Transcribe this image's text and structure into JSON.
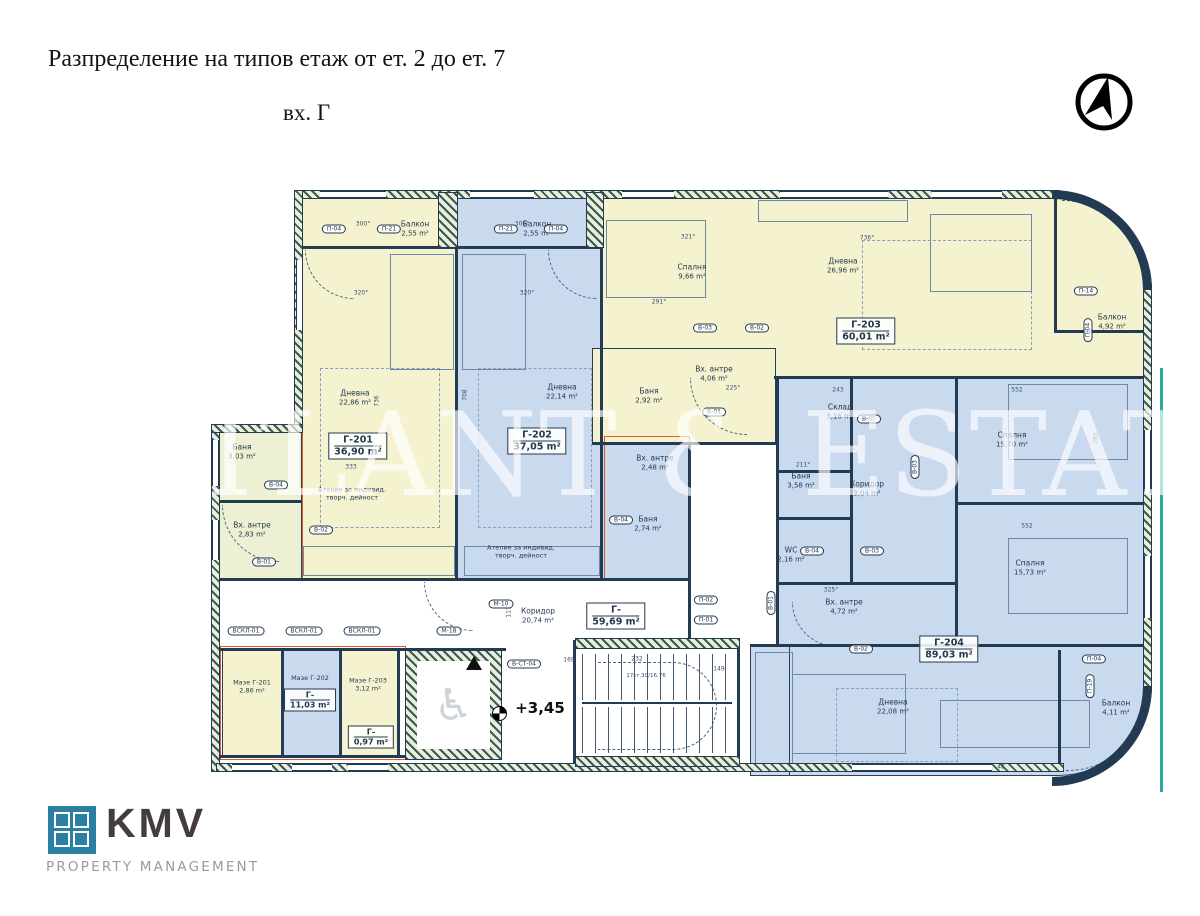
{
  "header": {
    "title": "Разпределение на типов етаж от ет. 2 до ет. 7",
    "entrance": "вх. Г"
  },
  "watermark": "ATLANT & ESTATE",
  "brand": {
    "name": "KMV",
    "tagline": "PROPERTY MANAGEMENT"
  },
  "level_mark": "+3,45",
  "stairs_note": "17ст.30/16,76",
  "colors": {
    "apartment_yellow": "#f5f2cf",
    "apartment_blue": "#c9daef",
    "annex_green": "#edf0d2",
    "line": "#223a52",
    "accent_red": "#dd5c2e",
    "frame_teal": "#2fa8a4",
    "logo_teal": "#2b7fa3"
  },
  "boxes": [
    {
      "id": "Г-201",
      "area": "36,90 m²"
    },
    {
      "id": "Г-202",
      "area": "37,05 m²"
    },
    {
      "id": "Г-203",
      "area": "60,01 m²"
    },
    {
      "id": "Г-204",
      "area": "89,03 m²"
    },
    {
      "id": "Г-",
      "area": "59,69 m²"
    },
    {
      "id": "Г-",
      "area": "11,03 m²"
    },
    {
      "id": "Г-",
      "area": "0,97 m²"
    }
  ],
  "rooms": [
    {
      "l1": "Дневна",
      "l2": "22,86 m²"
    },
    {
      "l1": "Балкон",
      "l2": "2,55 m²"
    },
    {
      "l1": "Ателие за индивид.",
      "l2": "творч. дейност"
    },
    {
      "l1": "Баня",
      "l2": "3,03 m²"
    },
    {
      "l1": "Вх. антре",
      "l2": "2,83 m²"
    },
    {
      "l1": "Дневна",
      "l2": "22,14 m²"
    },
    {
      "l1": "Балкон",
      "l2": "2,55 m²"
    },
    {
      "l1": "Ателие за индивид.",
      "l2": "творч. дейност"
    },
    {
      "l1": "Вх. антре",
      "l2": "2,48 m²"
    },
    {
      "l1": "Баня",
      "l2": "2,74 m²"
    },
    {
      "l1": "Спалня",
      "l2": "9,66 m²"
    },
    {
      "l1": "Дневна",
      "l2": "26,96 m²"
    },
    {
      "l1": "Балкон",
      "l2": "4,92 m²"
    },
    {
      "l1": "Вх. антре",
      "l2": "4,06 m²"
    },
    {
      "l1": "Баня",
      "l2": "2,92 m²"
    },
    {
      "l1": "Склад",
      "l2": "3,16 m²"
    },
    {
      "l1": "Баня",
      "l2": "3,58 m²"
    },
    {
      "l1": "Коридор",
      "l2": "3,04 m²"
    },
    {
      "l1": "WC",
      "l2": "2,16 m²"
    },
    {
      "l1": "Вх. антре",
      "l2": "4,72 m²"
    },
    {
      "l1": "Спалня",
      "l2": "15,70 m²"
    },
    {
      "l1": "Спалня",
      "l2": "15,73 m²"
    },
    {
      "l1": "Дневна",
      "l2": "22,08 m²"
    },
    {
      "l1": "Балкон",
      "l2": "4,11 m²"
    },
    {
      "l1": "Коридор",
      "l2": "20,74 m²"
    },
    {
      "l1": "Мазе Г-201",
      "l2": "2,86 m²"
    },
    {
      "l1": "Мазе Г-202",
      "l2": ""
    },
    {
      "l1": "Мазе Г-203",
      "l2": "3,12 m²"
    }
  ],
  "tags": [
    "П-04",
    "П-21",
    "П-21",
    "П-04",
    "В-01",
    "В-02",
    "В-04",
    "В-04",
    "В-03",
    "В-02",
    "В-01",
    "В-05",
    "В-03",
    "В-04",
    "В-03",
    "В-01",
    "В-02",
    "П-02",
    "П-01",
    "П-04",
    "П-19",
    "М-10",
    "М-18",
    "В-СТ-04",
    "ВСКЛ-01",
    "ВСКЛ-01",
    "ВСКЛ-01",
    "П-14",
    "П-04"
  ],
  "dims": [
    "300°",
    "300°",
    "320°",
    "320°",
    "321°",
    "736°",
    "291°",
    "333",
    "225°",
    "211°",
    "325°",
    "552",
    "552",
    "285",
    "243",
    "169",
    "232",
    "149",
    "117",
    "48",
    "736",
    "708"
  ]
}
